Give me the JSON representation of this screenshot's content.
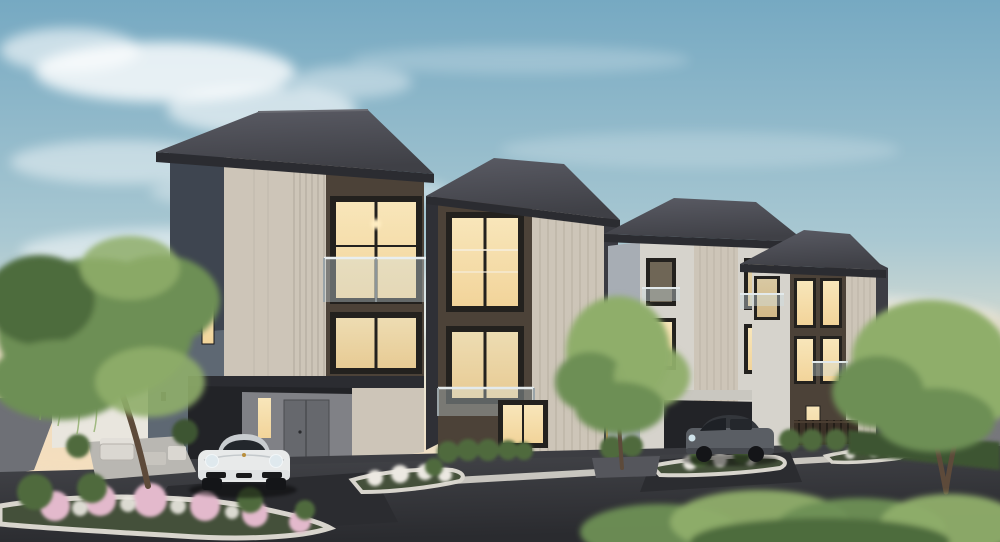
{
  "scene": {
    "type": "architectural-render",
    "subject": "modern three-storey duplex townhomes at dusk",
    "buildings": [
      {
        "id": "townhome-left-a",
        "storeys": 3,
        "features": [
          "hipped-dark-roof",
          "beige-striped-panel",
          "dark-brown-window-band",
          "glass-balcony",
          "lit-windows",
          "carport",
          "grey-front-door"
        ]
      },
      {
        "id": "townhome-left-b",
        "storeys": 3,
        "features": [
          "dark-brown-facade",
          "beige-siding-panel",
          "glass-balcony",
          "lit-windows"
        ]
      },
      {
        "id": "townhome-right-c",
        "storeys": 3,
        "features": [
          "light-walls",
          "balcony-rails",
          "carport-canopy",
          "lit-windows"
        ]
      },
      {
        "id": "townhome-right-d",
        "storeys": 3,
        "features": [
          "dark-brown-window-band",
          "beige-siding-panel",
          "timber-fence",
          "lit-windows"
        ]
      }
    ],
    "vehicles": [
      {
        "id": "white-sports-coupe",
        "color": "white",
        "location": "left-driveway"
      },
      {
        "id": "gray-suv",
        "color": "gray",
        "location": "right-carport"
      }
    ],
    "landscaping": [
      "large-tree-left",
      "small-tree-center",
      "tree-right",
      "pink-white-flower-island",
      "white-flower-islands",
      "hedges",
      "boundary-wall",
      "patio-furniture",
      "foreground-shrub"
    ],
    "foreground": "asphalt-street-with-white-curbs",
    "sky": "dusk-blue-with-soft-clouds-and-warm-horizon"
  },
  "palette": {
    "sky_top": "#76a9c2",
    "sky_mid": "#a9c8d2",
    "sky_low": "#e9e4d2",
    "sky_horizon": "#f3dfc2",
    "cloud": "#ffffff",
    "glow_warm": "#f6ddb8",
    "roof_dark": "#3f4046",
    "roof_light": "#5a5b64",
    "fascia": "#2b2c31",
    "wall_beige": "#cdc5b8",
    "wall_beige_shade": "#b2aa9d",
    "wall_light": "#d6d3cc",
    "wall_blue_shadow": "#5e6873",
    "wall_dark_blue": "#3e4550",
    "facade_brown": "#4c4238",
    "facade_brown_dark": "#3a332c",
    "window_frame": "#23211e",
    "window_lit": "#f2d49a",
    "window_lit_bright": "#f8e6ba",
    "rail_glass": "#cfe0e6",
    "road": "#2a2b2f",
    "road_light": "#46474c",
    "curb": "#d8d5cd",
    "paver": "#2b2c30",
    "plaza": "#3c3d42",
    "grass": "#6f8a52",
    "hedge": "#4f6b3e",
    "hedge_dark": "#3e5530",
    "foliage": "#6d8f55",
    "foliage_light": "#8fae6a",
    "foliage_dark": "#4e6c3c",
    "flower_pink": "#e3b9cc",
    "flower_white": "#ece9e2",
    "trunk": "#5d4a3a",
    "car_white": "#e8eaea",
    "car_shade": "#c9cdd0",
    "suv_gray": "#5a5e64",
    "suv_dark": "#33363b",
    "wall_far": "#77777c",
    "wall_white": "#e9e6de",
    "recess": "#222327",
    "door_gray": "#66686d"
  }
}
